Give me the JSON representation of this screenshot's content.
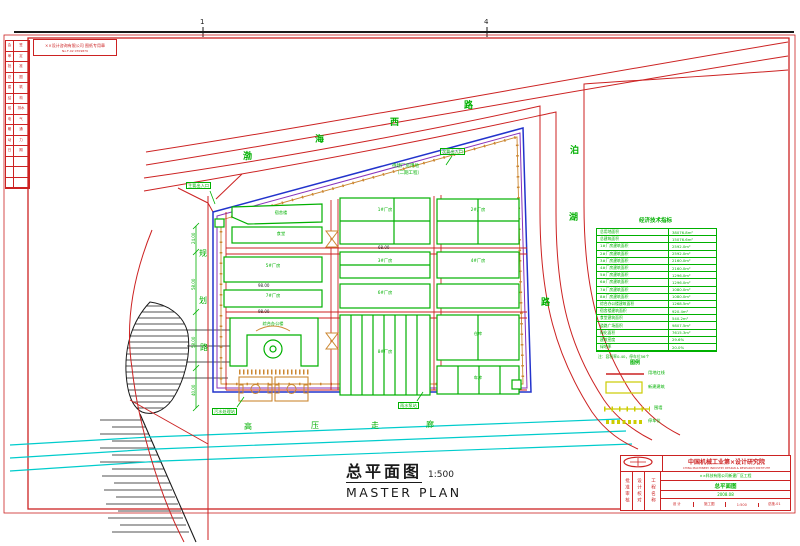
{
  "colors": {
    "red": "#cc2222",
    "green": "#00b000",
    "blue": "#2233cc",
    "cyan": "#00cccc",
    "yellow": "#cccc00",
    "orange": "#cc8833",
    "purple": "#8833bb",
    "black": "#1a1a1a"
  },
  "frame": {
    "fold_mark_1": "1",
    "fold_mark_2": "4",
    "stamp_line1": "××设计咨询有限公司 图纸专用章",
    "stamp_line2": "No.F-02 0709879"
  },
  "revision_rows": [
    {
      "a": "会",
      "b": "签"
    },
    {
      "a": "审",
      "b": "定"
    },
    {
      "a": "批",
      "b": "准"
    },
    {
      "a": "总",
      "b": "图"
    },
    {
      "a": "建",
      "b": "筑"
    },
    {
      "a": "结",
      "b": "构"
    },
    {
      "a": "给",
      "b": "排水"
    },
    {
      "a": "电",
      "b": "气"
    },
    {
      "a": "暖",
      "b": "通"
    },
    {
      "a": "动",
      "b": "力"
    },
    {
      "a": "日",
      "b": "期"
    },
    {
      "a": "",
      "b": ""
    },
    {
      "a": "",
      "b": ""
    },
    {
      "a": "",
      "b": ""
    }
  ],
  "roads": {
    "top_name": [
      "渤",
      "海",
      "西",
      "路"
    ],
    "right_name": [
      "泊",
      "湖",
      "路"
    ],
    "left_name": [
      "规",
      "划",
      "路"
    ],
    "corridor": [
      "高",
      "压",
      "走",
      "廊"
    ]
  },
  "site_labels": {
    "entrance_main": "主要出入口",
    "entrance_secondary": "次要出入口",
    "sewage": "污水处理站",
    "pump": "雨水泵站",
    "phase2_line1": "待建厂房用地",
    "phase2_line2": "（二期工程）"
  },
  "buildings": {
    "b1": "1#厂房",
    "b2": "2#厂房",
    "b3": "3#厂房",
    "b4": "4#厂房",
    "b5": "5#厂房",
    "b6": "6#厂房",
    "b7": "7#厂房",
    "b8": "8#厂房",
    "office": "综合办公楼",
    "dorm": "宿舍楼",
    "canteen": "食堂",
    "warehouse": "仓库",
    "garage": "车库"
  },
  "dims": {
    "v1": "24.00",
    "v2": "58.00",
    "v3": "58.00",
    "v4": "40.00",
    "h1": "98.00",
    "h2": "98.00",
    "h3": "68.00"
  },
  "econ_table": {
    "title": "经济技术指标",
    "rows": [
      {
        "l": "总用地面积",
        "v": "38076.8m²"
      },
      {
        "l": "总建筑面积",
        "v": "15076.6m²"
      },
      {
        "l": "1#厂房建筑面积",
        "v": "2592.0m²"
      },
      {
        "l": "2#厂房建筑面积",
        "v": "2592.0m²"
      },
      {
        "l": "3#厂房建筑面积",
        "v": "2160.0m²"
      },
      {
        "l": "4#厂房建筑面积",
        "v": "2160.0m²"
      },
      {
        "l": "5#厂房建筑面积",
        "v": "1296.0m²"
      },
      {
        "l": "6#厂房建筑面积",
        "v": "1296.0m²"
      },
      {
        "l": "7#厂房建筑面积",
        "v": "1080.0m²"
      },
      {
        "l": "8#厂房建筑面积",
        "v": "1080.0m²"
      },
      {
        "l": "综合办公楼建筑面积",
        "v": "1268.5m²"
      },
      {
        "l": "宿舍楼建筑面积",
        "v": "920.4m²"
      },
      {
        "l": "食堂建筑面积",
        "v": "540.2m²"
      },
      {
        "l": "道路广场面积",
        "v": "9807.5m²"
      },
      {
        "l": "绿化面积",
        "v": "7615.3m²"
      },
      {
        "l": "建筑密度",
        "v": "29.6%"
      },
      {
        "l": "绿地率",
        "v": "20.0%"
      }
    ],
    "note": "注：容积率0.40，停车位56个"
  },
  "legend": {
    "title": "图例",
    "items": [
      "用地红线",
      "新建建筑",
      "围墙",
      "停车位"
    ]
  },
  "main_title": {
    "zh": "总平面图",
    "scale": "1:500",
    "en": "MASTER PLAN"
  },
  "title_block": {
    "company": "中国机械工业第×设计研究院",
    "company_en": "CHINA MACHINERY INDUSTRY DESIGN & RESEARCH INSTITUTE",
    "col_a": "批准审核",
    "col_b": "设计校对",
    "col_c": "工程名称",
    "project": "××科技有限公司新建厂区工程",
    "drawing_name": "总平面图",
    "date": "2008.08",
    "cell1": "设 计",
    "cell2": "施工图",
    "cell3": "1:500",
    "cell4": "总施-01"
  }
}
